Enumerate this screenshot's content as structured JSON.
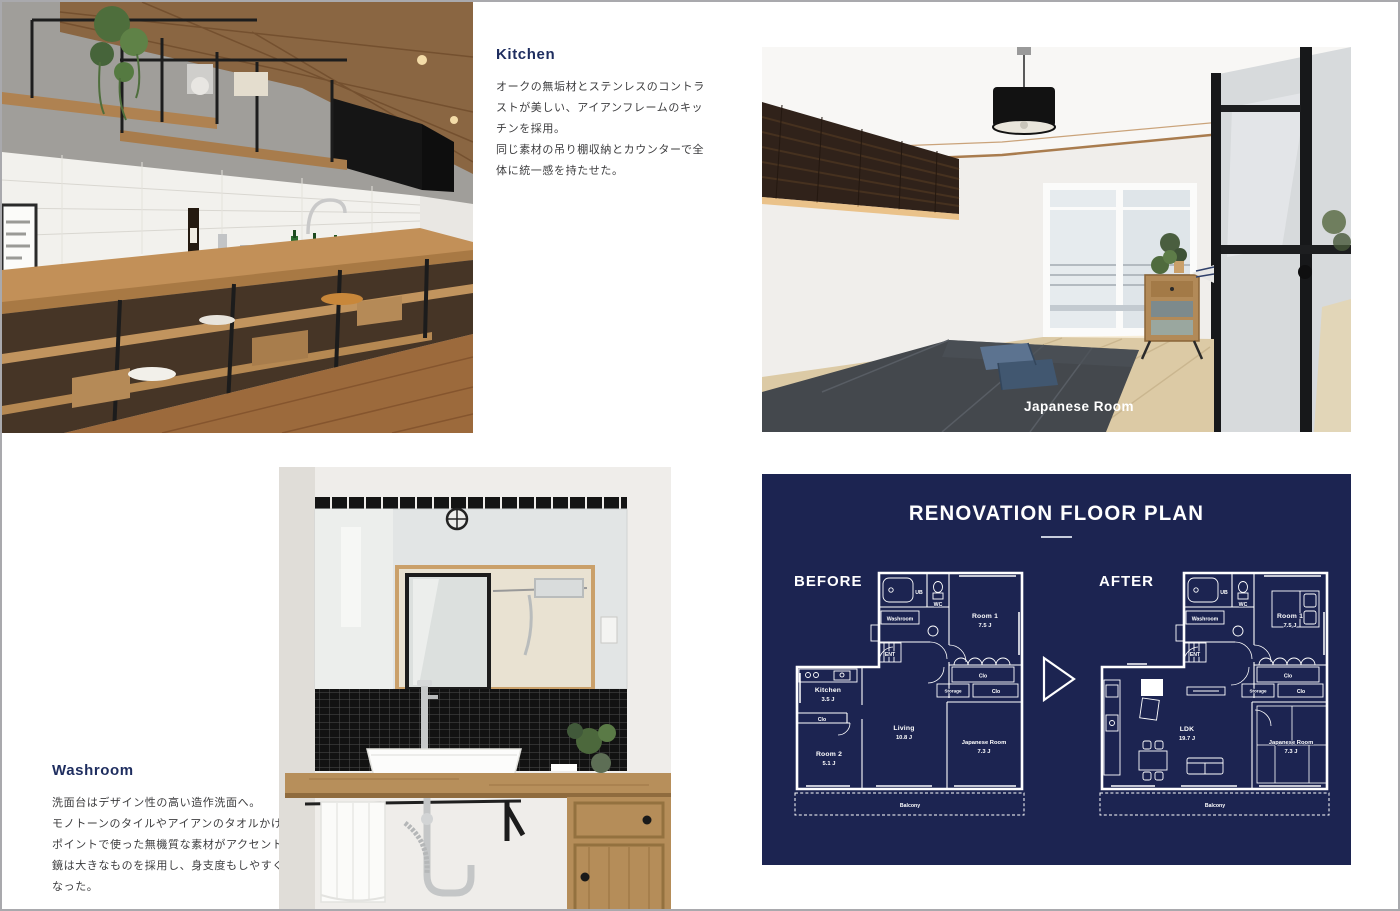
{
  "colors": {
    "panel_navy": "#1c2451",
    "heading_navy": "#1e2d5f",
    "body_text": "#3c3c3e",
    "plan_line": "#ffffff",
    "photo_label": "#ffffff"
  },
  "kitchen": {
    "title": "Kitchen",
    "lines": [
      "オークの無垢材とステンレスのコントラ",
      "ストが美しい、アイアンフレームのキッ",
      "チンを採用。",
      "同じ素材の吊り棚収納とカウンターで全",
      "体に統一感を持たせた。"
    ]
  },
  "washroom": {
    "title": "Washroom",
    "lines": [
      "洗面台はデザイン性の高い造作洗面へ。",
      "モノトーンのタイルやアイアンのタオルかけなど",
      "ポイントで使った無機質な素材がアクセントに。",
      "鏡は大きなものを採用し、身支度もしやすく",
      "なった。"
    ]
  },
  "japanese_room_photo": {
    "label": "Japanese Room"
  },
  "floor_plan": {
    "title": "RENOVATION FLOOR PLAN",
    "before": {
      "heading": "BEFORE",
      "labels": {
        "ub": "UB",
        "wc": "WC",
        "washroom": "Washroom",
        "ent": "ENT",
        "room1": "Room 1",
        "room1_size": "7.5 J",
        "clo_a": "Clo",
        "storage": "Storage",
        "clo_b": "Clo",
        "kitchen": "Kitchen",
        "kitchen_size": "3.5 J",
        "clo_c": "Clo",
        "room2": "Room 2",
        "room2_size": "5.1 J",
        "living": "Living",
        "living_size": "10.8 J",
        "japanese_room": "Japanese Room",
        "japanese_room_size": "7.3 J",
        "balcony": "Balcony"
      }
    },
    "after": {
      "heading": "AFTER",
      "labels": {
        "ub": "UB",
        "wc": "WC",
        "washroom": "Washroom",
        "ent": "ENT",
        "room1": "Room 1",
        "room1_size": "7.5 J",
        "clo_a": "Clo",
        "storage": "Storage",
        "clo_b": "Clo",
        "ldk": "LDK",
        "ldk_size": "19.7 J",
        "japanese_room": "Japanese Room",
        "japanese_room_size": "7.3 J",
        "balcony": "Balcony"
      }
    }
  }
}
